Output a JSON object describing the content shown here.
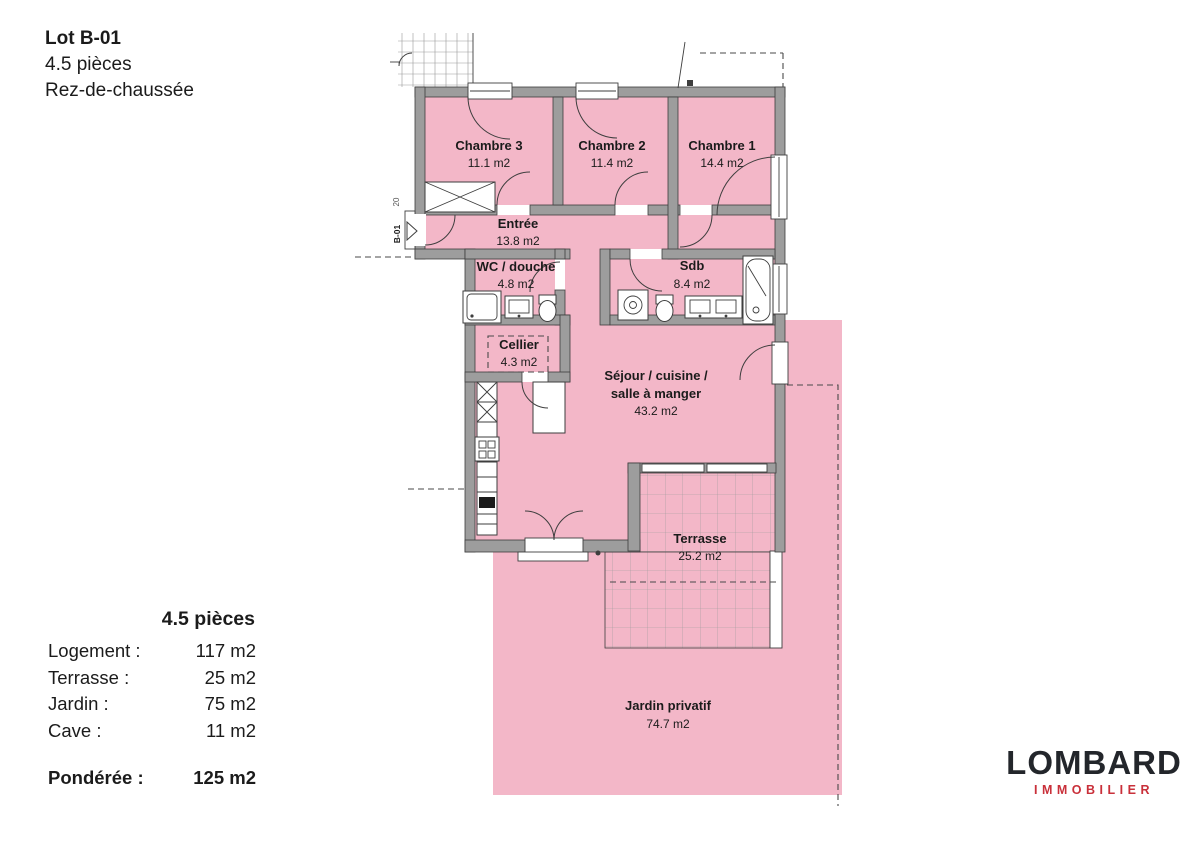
{
  "header": {
    "lot": "Lot B-01",
    "pieces": "4.5 pièces",
    "floor": "Rez-de-chaussée"
  },
  "plan": {
    "unit_marker": "B-01",
    "side_marker": "20",
    "rooms": [
      {
        "name": "Chambre 3",
        "area": "11.1 m2"
      },
      {
        "name": "Chambre 2",
        "area": "11.4 m2"
      },
      {
        "name": "Chambre 1",
        "area": "14.4 m2"
      },
      {
        "name": "Entrée",
        "area": "13.8 m2"
      },
      {
        "name": "WC / douche",
        "area": "4.8 m2"
      },
      {
        "name": "Sdb",
        "area": "8.4 m2"
      },
      {
        "name": "Cellier",
        "area": "4.3 m2"
      },
      {
        "name": "Séjour / cuisine /",
        "name2": "salle à manger",
        "area": "43.2 m2"
      },
      {
        "name": "Terrasse",
        "area": "25.2 m2"
      },
      {
        "name": "Jardin privatif",
        "area": "74.7 m2"
      }
    ]
  },
  "summary": {
    "title": "4.5 pièces",
    "rows": [
      {
        "label": "Logement :",
        "value": "117 m2"
      },
      {
        "label": "Terrasse :",
        "value": "25 m2"
      },
      {
        "label": "Jardin :",
        "value": "75 m2"
      },
      {
        "label": "Cave :",
        "value": "11 m2"
      }
    ],
    "weighted_label": "Pondérée :",
    "weighted_value": "125 m2"
  },
  "logo": {
    "name": "LOMBARD",
    "subtitle": "IMMOBILIER"
  },
  "colors": {
    "room_pink": "#f3b7c8",
    "wall_gray": "#9d9d9d",
    "logo_red": "#c9303a",
    "ink": "#1b1b1b"
  }
}
